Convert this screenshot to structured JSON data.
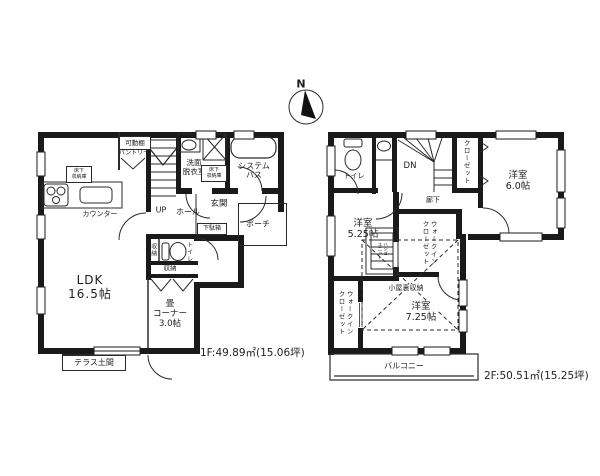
{
  "compass": {
    "north_label": "N"
  },
  "floor1": {
    "area_label": "1F:49.89㎡(15.06坪)",
    "rooms": {
      "ldk": "LDK\n16.5帖",
      "tatami_corner": "畳\nコーナー\n3.0帖",
      "washroom": "洗面\n脱衣室",
      "system_bath": "システム\nバス",
      "entrance": "玄関",
      "hall": "ホール",
      "up": "UP",
      "porch": "ポーチ",
      "toilet": "トイレ",
      "storage_side": "収納",
      "storage": "収納",
      "shoe_cabinet": "下駄箱",
      "counter": "カウンター",
      "movable_shelf": "可動棚",
      "pantry": "パントリー",
      "underfloor_storage_kitchen": "床下\n収納庫",
      "underfloor_storage_washroom": "床下\n収納庫",
      "terrace": "テラス土間"
    }
  },
  "floor2": {
    "area_label": "2F:50.51㎡(15.25坪)",
    "rooms": {
      "toilet": "トイレ",
      "down": "DN",
      "closet": "クローゼット",
      "western_room_6": "洋室\n6.0帖",
      "corridor": "廊下",
      "western_room_525": "洋室\n5.25帖",
      "ladder_unit": "ハシゴ\nユニット",
      "walkin_closet_center": "ウォークイン\nクローゼット",
      "walkin_closet_left": "ウォークイン\nクローゼット",
      "attic_storage": "小屋裏収納",
      "western_room_725": "洋室\n7.25帖",
      "balcony": "バルコニー"
    }
  }
}
